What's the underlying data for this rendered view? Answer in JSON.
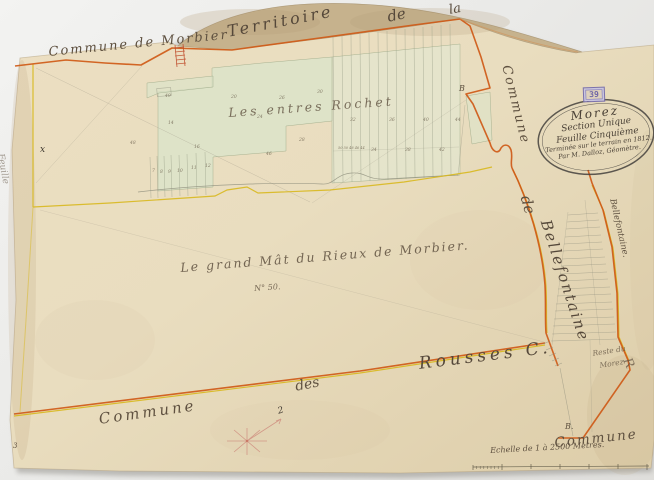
{
  "map": {
    "boundary_labels": {
      "commune_de_morbier": "Commune de Morbier",
      "territoire": "Territoire",
      "de_top": "de",
      "la_top": "la",
      "commune_right": "Commune",
      "de_right": "de",
      "bellefontaine_large": "Bellefontaine",
      "bellefontaine_small": "Bellefontaine.",
      "rousses": "Rousses C.",
      "des_bottom": "des",
      "commune_bottom_left": "Commune",
      "commune_bottom_right": "Commune"
    },
    "place_labels": {
      "lieu_dit_rochet": "Les entres Rochet",
      "lieu_dit_grand_mat": "Le grand Mât du Rieux de Morbier.",
      "lieu_dit_grand_mat_no": "N° 50.",
      "corner_parcel_line1": "Reste du",
      "corner_parcel_line2": "Morez",
      "corner_letter": "R"
    },
    "cartouche": {
      "title": "Morez",
      "line2": "Section Unique",
      "line3": "Feuille Cinquième",
      "line4": "Terminée sur le terrain en 1812.",
      "line5": "Par M. Dalloz, Géomètre."
    },
    "stamp": "39",
    "scale_text": "Echelle de 1 à 2500 Mètres.",
    "marks": {
      "b_marker_1": "B",
      "b_marker_2": "B.",
      "x_mark": "x",
      "page_number": "3",
      "feuille_left": "Feuille",
      "compass_north": "2"
    },
    "parcel_numbers": [
      {
        "x": 168,
        "y": 122,
        "t": "14"
      },
      {
        "x": 194,
        "y": 146,
        "t": "16"
      },
      {
        "x": 231,
        "y": 96,
        "t": "20"
      },
      {
        "x": 257,
        "y": 116,
        "t": "24"
      },
      {
        "x": 279,
        "y": 97,
        "t": "26"
      },
      {
        "x": 299,
        "y": 139,
        "t": "28"
      },
      {
        "x": 317,
        "y": 91,
        "t": "30"
      },
      {
        "x": 350,
        "y": 119,
        "t": "32"
      },
      {
        "x": 371,
        "y": 149,
        "t": "34"
      },
      {
        "x": 389,
        "y": 119,
        "t": "36"
      },
      {
        "x": 405,
        "y": 149,
        "t": "38"
      },
      {
        "x": 423,
        "y": 119,
        "t": "40"
      },
      {
        "x": 439,
        "y": 149,
        "t": "42"
      },
      {
        "x": 455,
        "y": 119,
        "t": "44"
      },
      {
        "x": 338,
        "y": 147,
        "t": "50 50 48 46 44",
        "s": 3.5
      },
      {
        "x": 152,
        "y": 170,
        "t": "7"
      },
      {
        "x": 160,
        "y": 171,
        "t": "8"
      },
      {
        "x": 168,
        "y": 171,
        "t": "9"
      },
      {
        "x": 177,
        "y": 170,
        "t": "10"
      },
      {
        "x": 191,
        "y": 167,
        "t": "11"
      },
      {
        "x": 205,
        "y": 165,
        "t": "12"
      },
      {
        "x": 266,
        "y": 153,
        "t": "46"
      },
      {
        "x": 165,
        "y": 95,
        "t": "49"
      },
      {
        "x": 130,
        "y": 142,
        "t": "48"
      }
    ],
    "colors": {
      "boundary_orange": "#cf5a17",
      "boundary_yellow": "#d9b81e",
      "parcel_green": "#dce4c9",
      "paper": "#e9ddbf",
      "flap_tan": "#c6b28d",
      "stamp_purple": "#7b72ad",
      "ink": "#5f5140",
      "red_hatch": "#bf4a2a"
    }
  }
}
